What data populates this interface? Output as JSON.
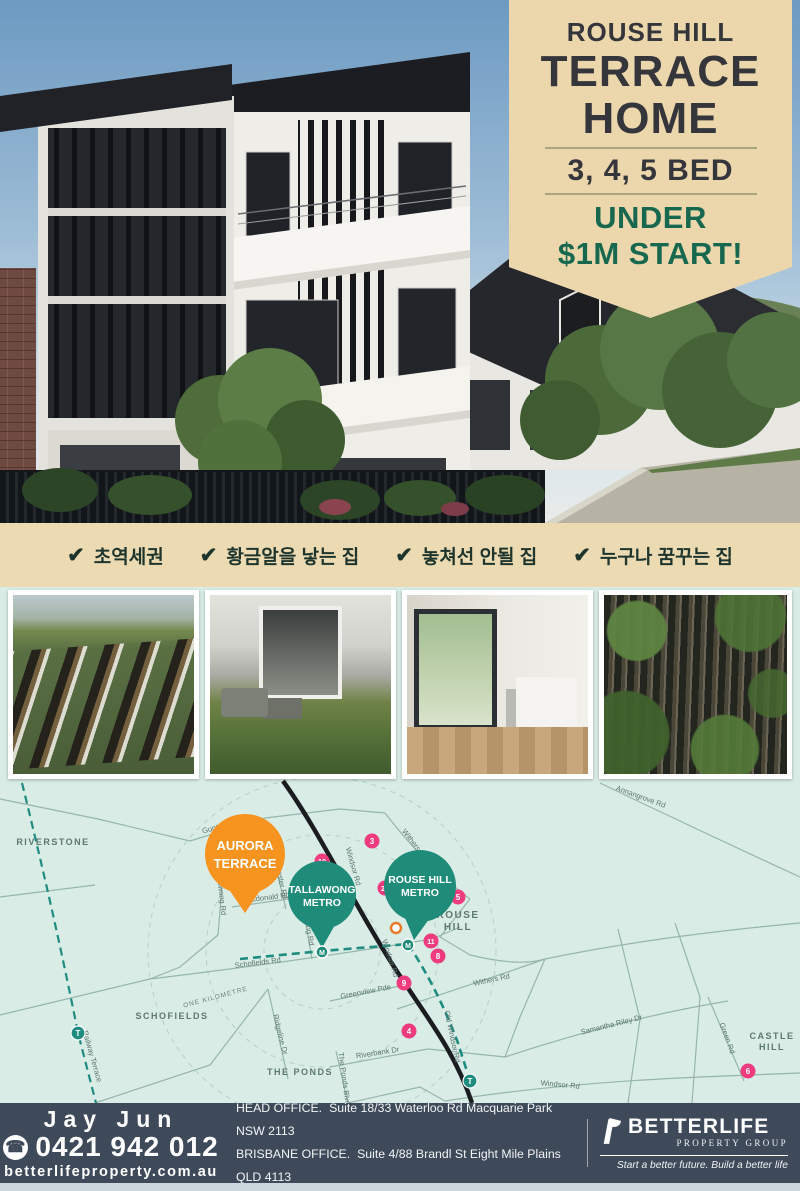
{
  "badge": {
    "location": "ROUSE HILL",
    "product_line1": "TERRACE",
    "product_line2": "HOME",
    "beds": "3, 4, 5 BED",
    "price_line1": "UNDER",
    "price_line2": "$1M START!",
    "colors": {
      "background": "#ecd7ac",
      "text": "#35363b",
      "accent": "#17684f"
    }
  },
  "features": {
    "check_icon": "✔",
    "items": [
      "초역세권",
      "황금알을 낳는 집",
      "놓쳐선 안될 집",
      "누구나 꿈꾸는 집"
    ]
  },
  "photos": [
    {
      "id": "aerial",
      "description": "Aerial view of terrace home community"
    },
    {
      "id": "courtyard",
      "description": "Private courtyard with lawn and BBQ"
    },
    {
      "id": "living",
      "description": "Open plan living and kitchen interior"
    },
    {
      "id": "balcony",
      "description": "Timber screened balcony with plants"
    }
  ],
  "map": {
    "colors": {
      "background": "#d9ece6",
      "road": "#96b6ac",
      "rail": "#1a1c20",
      "metro": "#1e8c80",
      "marker": "#ee3c7e",
      "pin_orange": "#f79420",
      "pin_teal": "#1f8b79"
    },
    "suburbs": {
      "riverstone": "RIVERSTONE",
      "schofields": "SCHOFIELDS",
      "the_ponds": "THE PONDS",
      "rouse_hill_line1": "ROUSE",
      "rouse_hill_line2": "HILL",
      "castle_hill_line1": "CASTLE",
      "castle_hill_line2": "HILL"
    },
    "pins": {
      "aurora": {
        "line1": "AURORA",
        "line2": "TERRACE"
      },
      "tallawong": {
        "line1": "TALLAWONG",
        "line2": "METRO"
      },
      "rouse_hill": {
        "line1": "ROUSE HILL",
        "line2": "METRO"
      }
    },
    "road_labels": [
      "Annangrove Rd",
      "Withers Rd",
      "Withers Rd",
      "Guntawong Rd",
      "Tallawong Rd",
      "Worcester Rd",
      "Cudgegong Rd",
      "Macdonald Rd",
      "Schofields Rd",
      "Greenview Pde",
      "Ridgeline Dr",
      "Riverbank Dr",
      "The Ponds Blvd",
      "Samantha Riley Dr",
      "Green Rd",
      "Windsor Rd",
      "Windsor Rd",
      "Old Windsor Rd",
      "Windsor Rd",
      "Railway Terrace"
    ],
    "numbered_markers": [
      "3",
      "10",
      "22",
      "5",
      "11",
      "8",
      "9",
      "4",
      "6"
    ],
    "transit": {
      "metro_glyph": "M",
      "train_glyph": "T",
      "scale_label": "ONE KILOMETRE"
    }
  },
  "footer": {
    "agent": {
      "name": "Jay Jun",
      "phone": "0421 942 012",
      "website": "betterlifeproperty.com.au",
      "phone_icon": "☎"
    },
    "offices": [
      {
        "label": "HEAD OFFICE.",
        "address": "Suite 18/33 Waterloo Rd Macquarie Park NSW 2113"
      },
      {
        "label": "BRISBANE OFFICE.",
        "address": "Suite 4/88 Brandl St Eight Mile Plains QLD 4113"
      }
    ],
    "brand": {
      "name": "BETTERLIFE",
      "division": "PROPERTY GROUP",
      "slogan": "Start a better future. Build a better life"
    }
  }
}
